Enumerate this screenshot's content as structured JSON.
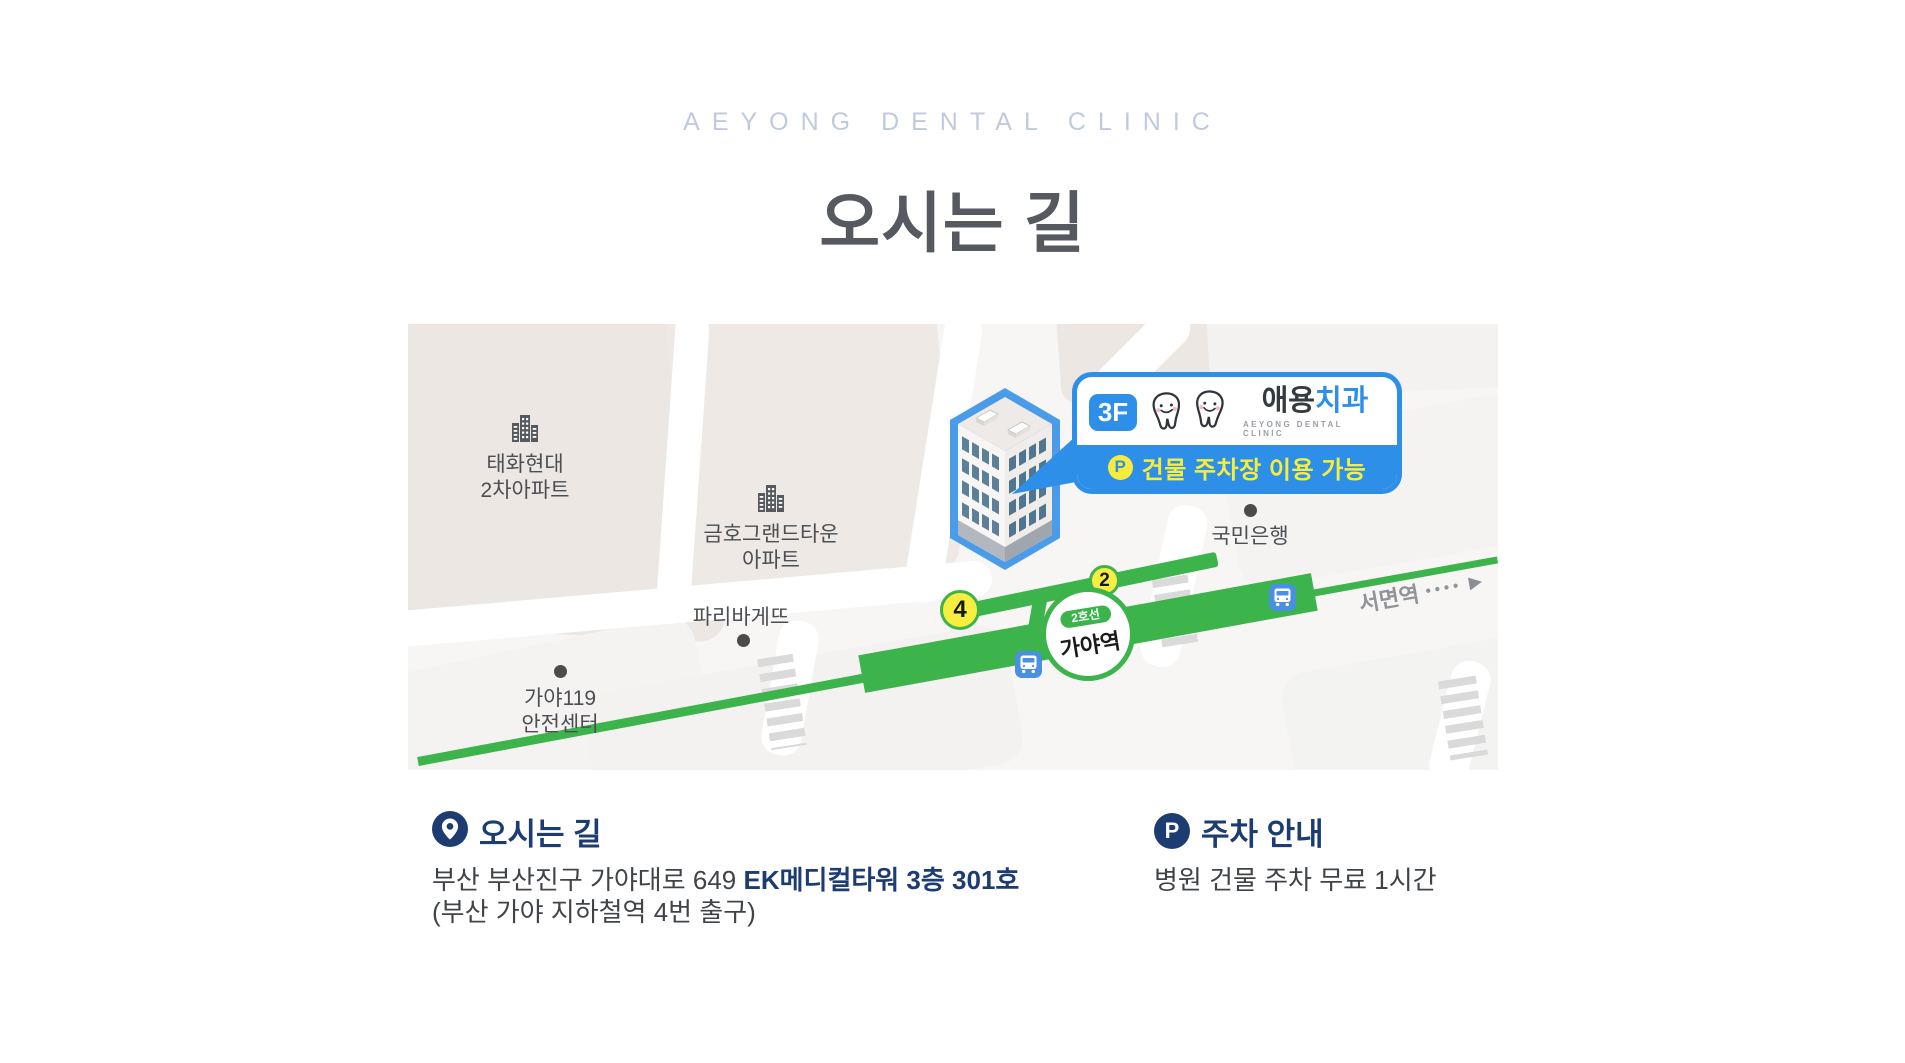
{
  "header": {
    "subtitle": "AEYONG DENTAL CLINIC",
    "title": "오시는 길"
  },
  "map": {
    "labels": {
      "apartment1_line1": "태화현대",
      "apartment1_line2": "2차아파트",
      "apartment2_line1": "금호그랜드타운",
      "apartment2_line2": "아파트",
      "bakery": "파리바게뜨",
      "fire_line1": "가야119",
      "fire_line2": "안전센터",
      "bank": "국민은행",
      "direction_text": "서면역",
      "direction_dots": "••••",
      "direction_arrow": "▶"
    },
    "station": {
      "line_badge": "2호선",
      "name": "가야역"
    },
    "exits": {
      "exit4": "4",
      "exit2": "2"
    },
    "callout": {
      "floor_badge": "3F",
      "name_prefix": "애용",
      "name_suffix": "치과",
      "name_sub": "AEYONG DENTAL CLINIC",
      "parking_letter": "P",
      "parking_text": "건물 주차장 이용 가능"
    }
  },
  "info": {
    "directions": {
      "heading": "오시는 길",
      "address_regular": "부산 부산진구 가야대로 649 ",
      "address_bold": "EK메디컬타워 3층 301호",
      "address_note": "(부산 가야 지하철역 4번 출구)"
    },
    "parking": {
      "heading": "주차 안내",
      "icon_letter": "P",
      "body": "병원 건물 주차 무료 1시간"
    }
  },
  "colors": {
    "accent_blue": "#2e8fe8",
    "line_green": "#3cb44b",
    "navy": "#1d3c72",
    "exit_yellow": "#f8ee3f",
    "title_gray": "#56595f",
    "subtitle_gray": "#bfcbdc"
  }
}
